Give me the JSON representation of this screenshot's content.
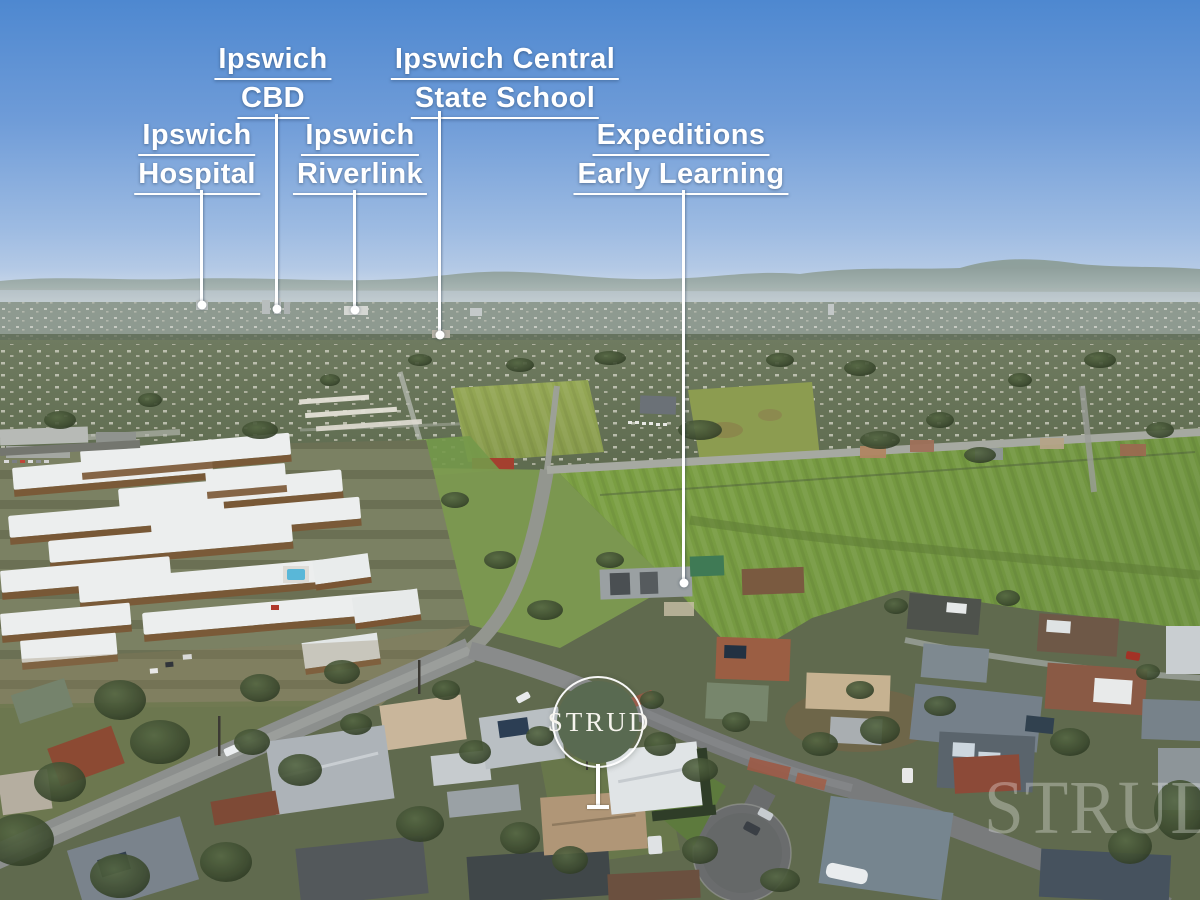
{
  "annotations": {
    "labels": [
      {
        "id": "ipswich-cbd",
        "line1": "Ipswich",
        "line2": "CBD"
      },
      {
        "id": "ipswich-central-state-school",
        "line1": "Ipswich Central",
        "line2": "State School"
      },
      {
        "id": "ipswich-hospital",
        "line1": "Ipswich",
        "line2": "Hospital"
      },
      {
        "id": "ipswich-riverlink",
        "line1": "Ipswich",
        "line2": "Riverlink"
      },
      {
        "id": "expeditions-early-learning",
        "line1": "Expeditions",
        "line2": "Early Learning"
      }
    ]
  },
  "brand": {
    "badge_text": "STRUD",
    "watermark_text": "STRUD",
    "badge_color": "#596a51",
    "annotation_color": "#ffffff"
  }
}
